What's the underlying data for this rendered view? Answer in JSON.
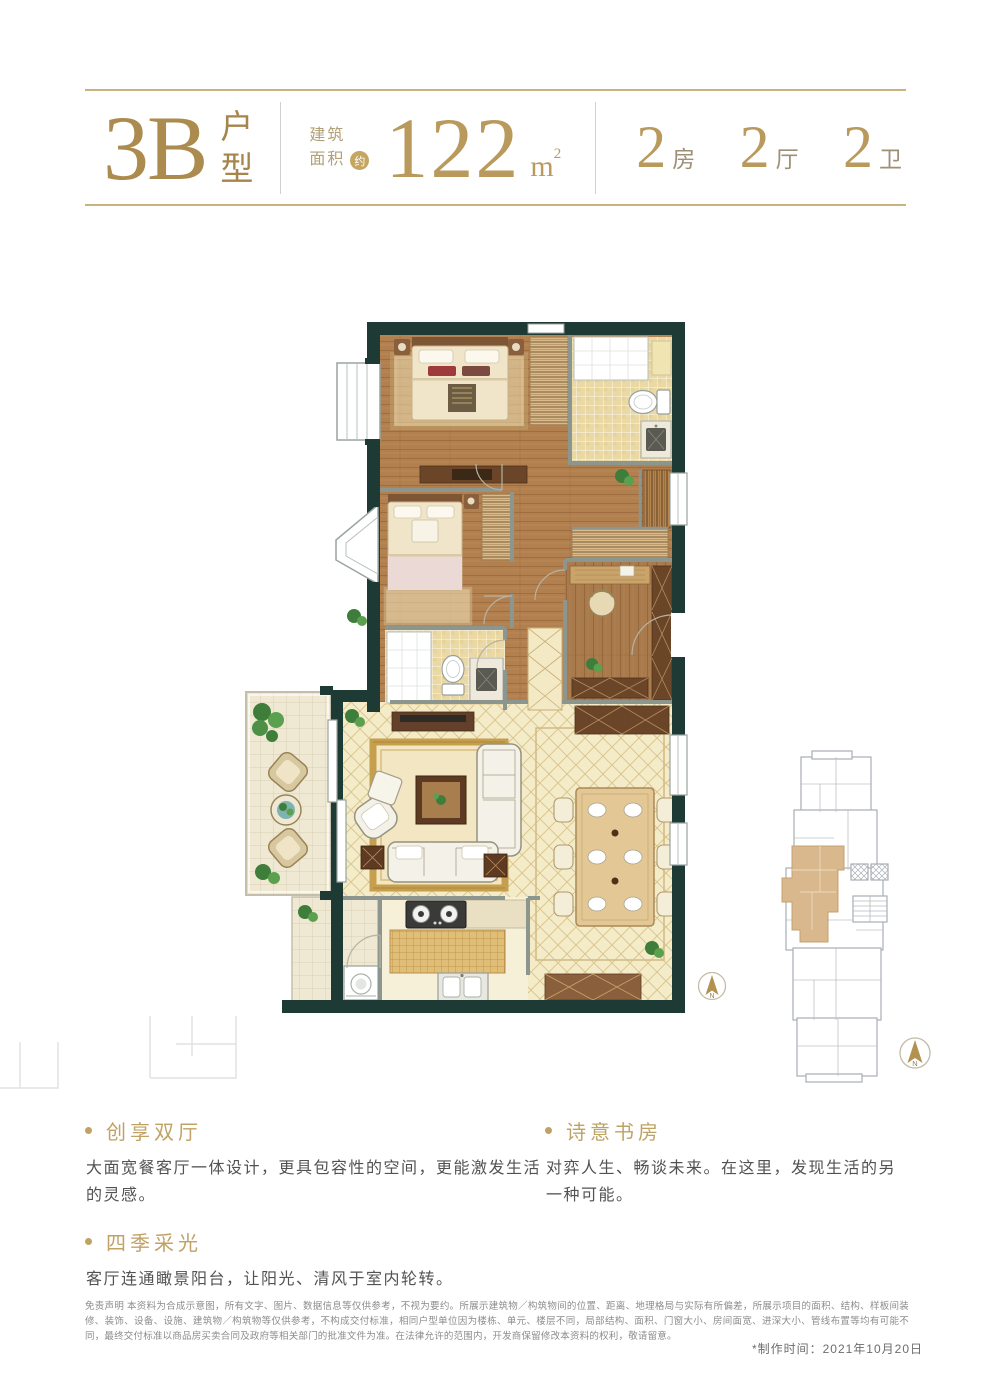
{
  "header": {
    "unit_code": "3B",
    "unit_type": "户\n型",
    "area_label": "建筑\n面积",
    "area_approx": "约",
    "area_value": "122",
    "area_unit_base": "m",
    "area_unit_sup": "2",
    "rooms": [
      {
        "num": "2",
        "label": "房"
      },
      {
        "num": "2",
        "label": "厅"
      },
      {
        "num": "2",
        "label": "卫"
      }
    ]
  },
  "plan": {
    "compass_n": "N",
    "rooms_depicted": [
      "主卧",
      "次卧",
      "卫生间×2",
      "书房",
      "客厅",
      "餐厅",
      "厨房",
      "阳台",
      "设备平台"
    ],
    "colors": {
      "wall": "#1d3a34",
      "partition": "#8d958f",
      "wood_floor": "#b2804f",
      "pale_floor": "#f4ebc8",
      "bath_tile": "#ead9a4",
      "balcony_tile": "#efe9d4",
      "accent_gold": "#c0a264",
      "keyplan_highlight": "#d8b88c"
    }
  },
  "keyplan": {
    "compass_n": "N"
  },
  "features": {
    "left": [
      {
        "title": "创享双厅",
        "body": "大面宽餐客厅一体设计，更具包容性的空间，更能激发生活的灵感。"
      },
      {
        "title": "四季采光",
        "body": "客厅连通瞰景阳台，让阳光、清风于室内轮转。"
      }
    ],
    "right": [
      {
        "title": "诗意书房",
        "body": "对弈人生、畅谈未来。在这里，发现生活的另一种可能。"
      }
    ]
  },
  "footer": {
    "disclaimer": "免责声明 本资料为合成示意图，所有文字、图片、数据信息等仅供参考，不视为要约。所展示建筑物／构筑物间的位置、距离、地理格局与实际有所偏差，所展示项目的面积、结构、样板间装修、装饰、设备、设施、建筑物／构筑物等仅供参考，不构成交付标准，相同户型单位因为楼栋、单元、楼层不同，局部结构、面积、门窗大小、房间面宽、进深大小、管线布置等均有可能不同，最终交付标准以商品房买卖合同及政府等相关部门的批准文件为准。在法律允许的范围内，开发商保留修改本资料的权利，敬请留意。",
    "date_note": "*制作时间：2021年10月20日"
  }
}
